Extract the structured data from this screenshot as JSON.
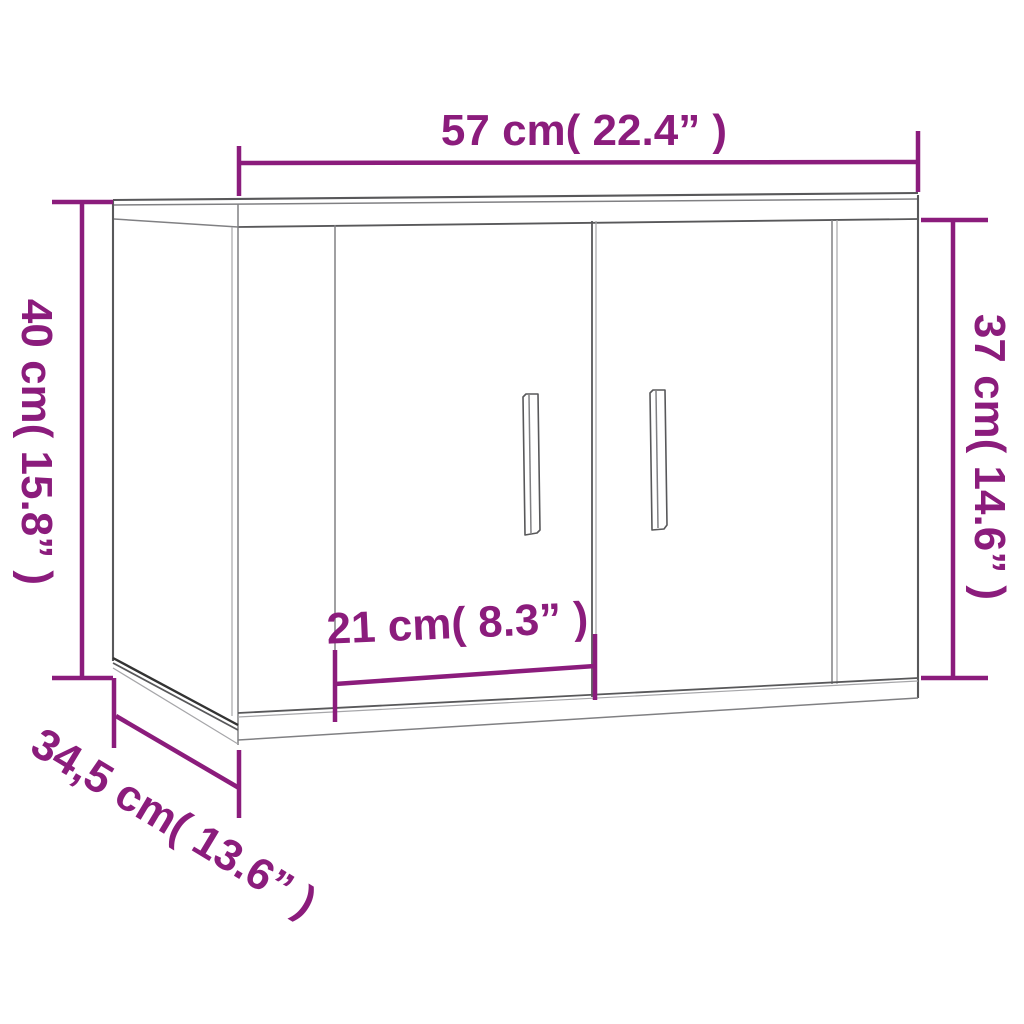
{
  "figure": {
    "description": "3D line drawing of a two-door wall-mounted cabinet annotated with five dimension callouts"
  },
  "colors": {
    "accent": "#8b1c7c",
    "line_dark": "#333333",
    "line_main": "#58585a",
    "line_mid": "#808083",
    "line_light": "#a6a6a9",
    "background": "#ffffff"
  },
  "dimensions": {
    "width": {
      "label": "57 cm( 22.4” )",
      "position": "top"
    },
    "height": {
      "label": "40 cm( 15.8” )",
      "position": "left"
    },
    "front_height": {
      "label": "37 cm( 14.6” )",
      "position": "right"
    },
    "door_width": {
      "label": "21 cm( 8.3” )",
      "position": "center"
    },
    "depth": {
      "label": "34,5 cm( 13.6” )",
      "position": "bottom-left"
    }
  }
}
